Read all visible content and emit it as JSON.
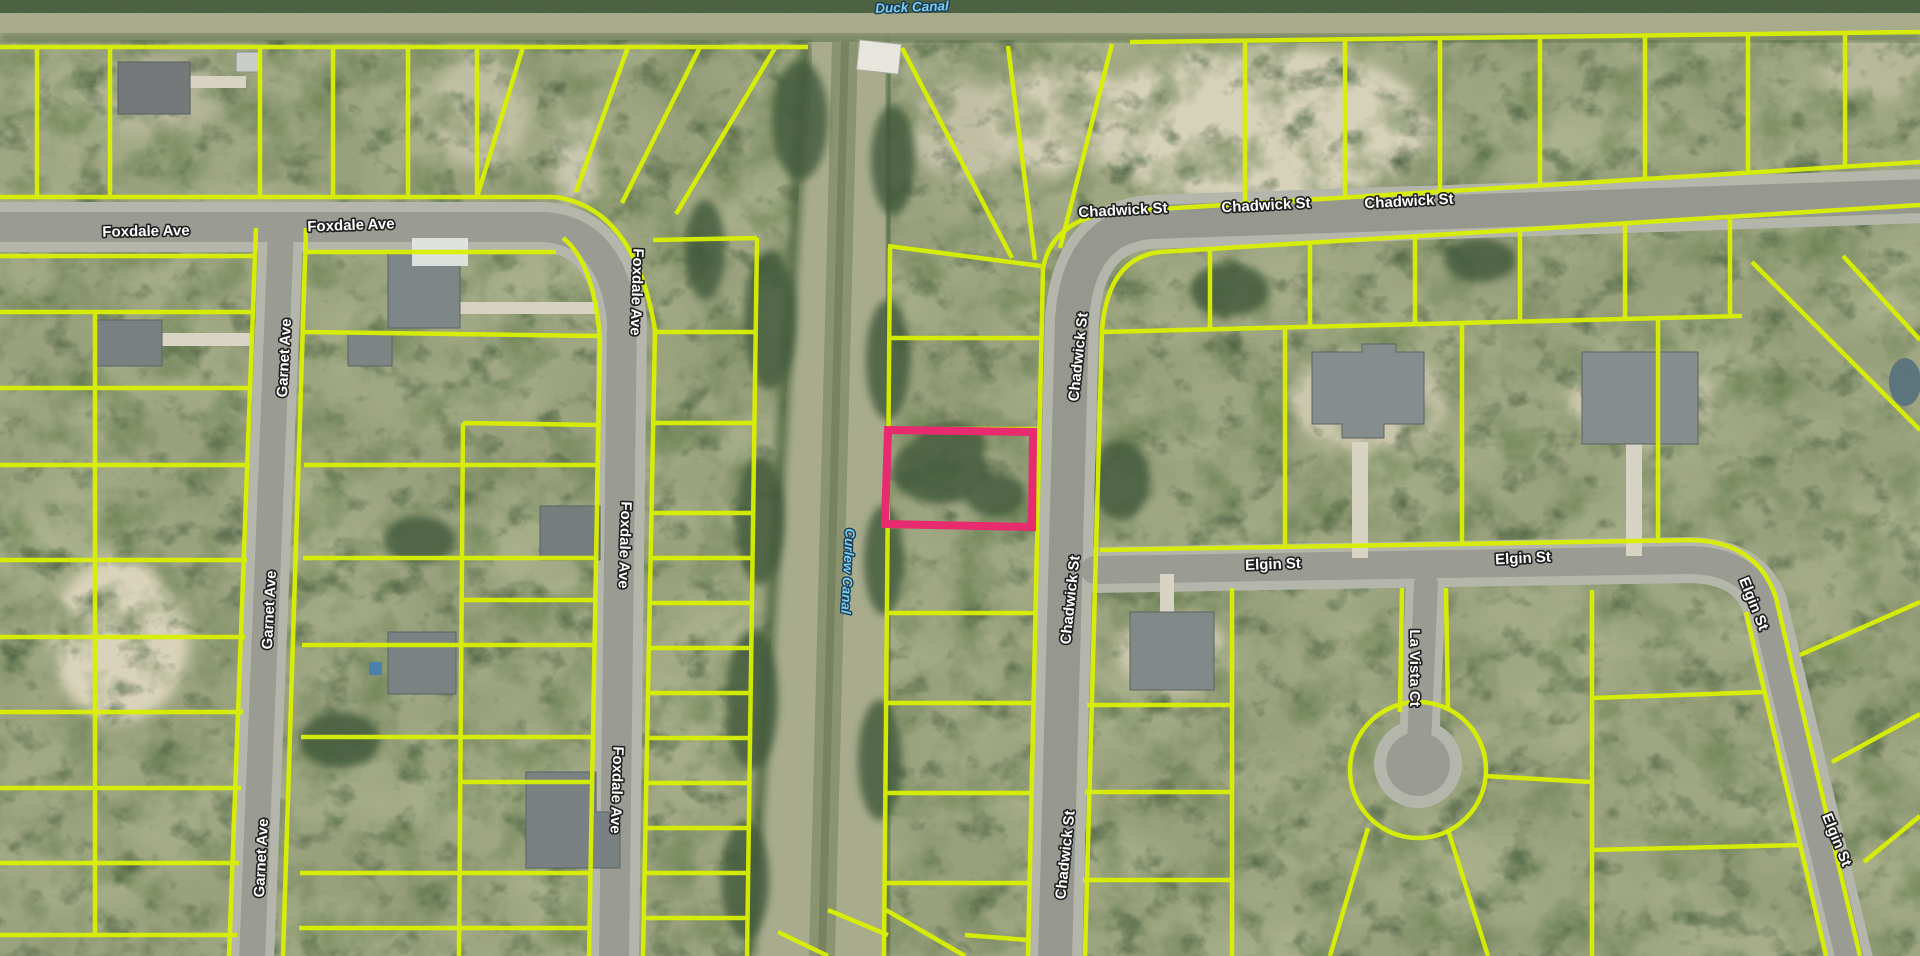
{
  "map": {
    "type": "aerial-parcel-map",
    "colors": {
      "parcel_line": "#d9f000",
      "highlight": "#e82a6e",
      "street_text": "#ffffff",
      "street_halo": "#1f1f1f",
      "canal_text": "#79cef2",
      "canal_halo": "#1d3c52"
    },
    "highlight_parcel": {
      "points": "888,430 1033,432 1032,527 885,524"
    },
    "labels": [
      {
        "name": "street-label-foxdale-ave-1",
        "text": "Foxdale Ave",
        "x": 146,
        "y": 232,
        "rot": -1,
        "kind": "street"
      },
      {
        "name": "street-label-foxdale-ave-2",
        "text": "Foxdale Ave",
        "x": 351,
        "y": 226,
        "rot": -2,
        "kind": "street"
      },
      {
        "name": "street-label-chadwick-st-1",
        "text": "Chadwick St",
        "x": 1123,
        "y": 211,
        "rot": -3,
        "kind": "street"
      },
      {
        "name": "street-label-chadwick-st-2",
        "text": "Chadwick St",
        "x": 1266,
        "y": 206,
        "rot": -3,
        "kind": "street"
      },
      {
        "name": "street-label-chadwick-st-3",
        "text": "Chadwick St",
        "x": 1409,
        "y": 202,
        "rot": -3,
        "kind": "street"
      },
      {
        "name": "street-label-garnet-ave-1",
        "text": "Garnet Ave",
        "x": 285,
        "y": 358,
        "rot": -87,
        "kind": "street"
      },
      {
        "name": "street-label-garnet-ave-2",
        "text": "Garnet Ave",
        "x": 270,
        "y": 610,
        "rot": -87,
        "kind": "street"
      },
      {
        "name": "street-label-garnet-ave-3",
        "text": "Garnet Ave",
        "x": 262,
        "y": 858,
        "rot": -87,
        "kind": "street"
      },
      {
        "name": "street-label-foxdale-ave-v1",
        "text": "Foxdale Ave",
        "x": 636,
        "y": 292,
        "rot": 92,
        "kind": "street"
      },
      {
        "name": "street-label-foxdale-ave-v2",
        "text": "Foxdale Ave",
        "x": 624,
        "y": 545,
        "rot": 92,
        "kind": "street"
      },
      {
        "name": "street-label-foxdale-ave-v3",
        "text": "Foxdale Ave",
        "x": 616,
        "y": 790,
        "rot": 92,
        "kind": "street"
      },
      {
        "name": "street-label-chadwick-st-v1",
        "text": "Chadwick St",
        "x": 1079,
        "y": 357,
        "rot": -84,
        "kind": "street"
      },
      {
        "name": "street-label-chadwick-st-v2",
        "text": "Chadwick St",
        "x": 1071,
        "y": 600,
        "rot": -84,
        "kind": "street"
      },
      {
        "name": "street-label-chadwick-st-v3",
        "text": "Chadwick St",
        "x": 1066,
        "y": 855,
        "rot": -84,
        "kind": "street"
      },
      {
        "name": "street-label-elgin-st-1",
        "text": "Elgin St",
        "x": 1273,
        "y": 565,
        "rot": -2,
        "kind": "street"
      },
      {
        "name": "street-label-elgin-st-2",
        "text": "Elgin St",
        "x": 1523,
        "y": 559,
        "rot": -3,
        "kind": "street"
      },
      {
        "name": "street-label-elgin-st-d1",
        "text": "Elgin St",
        "x": 1753,
        "y": 604,
        "rot": 68,
        "kind": "street"
      },
      {
        "name": "street-label-elgin-st-d2",
        "text": "Elgin St",
        "x": 1836,
        "y": 840,
        "rot": 68,
        "kind": "street"
      },
      {
        "name": "street-label-la-vista-ct",
        "text": "La Vista Ct",
        "x": 1414,
        "y": 668,
        "rot": 90,
        "kind": "street"
      },
      {
        "name": "canal-label-duck-canal",
        "text": "Duck Canal",
        "x": 912,
        "y": 8,
        "rot": -2,
        "kind": "canal"
      },
      {
        "name": "canal-label-curlew-canal",
        "text": "Curlew Canal",
        "x": 847,
        "y": 571,
        "rot": 93,
        "kind": "canal"
      }
    ]
  }
}
